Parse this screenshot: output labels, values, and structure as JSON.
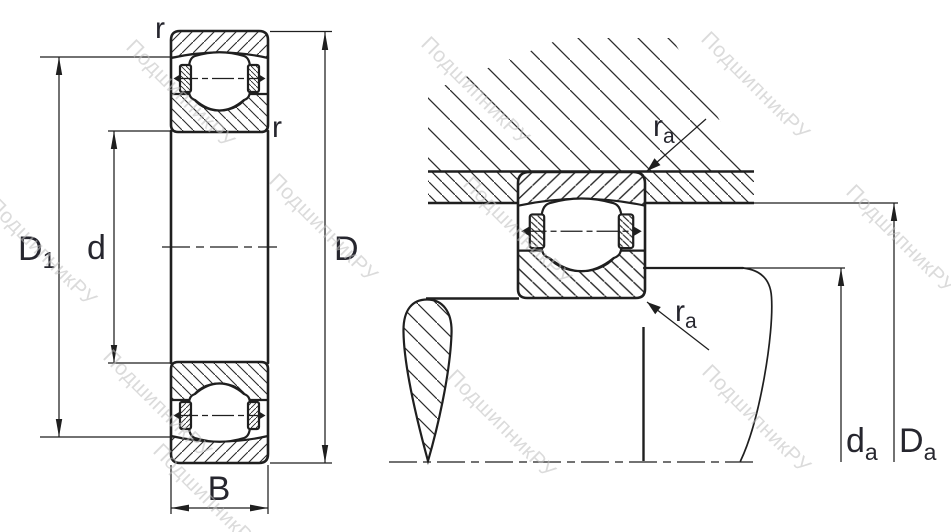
{
  "drawing": {
    "type": "bearing-dimension-diagram",
    "watermark": {
      "text": "ПодшипникРУ"
    },
    "left_view": {
      "label_r_top": "r",
      "label_r_side": "r",
      "dim_D1": {
        "base": "D",
        "sub": "1"
      },
      "dim_d": "d",
      "dim_D": "D",
      "dim_B": "B"
    },
    "right_view": {
      "label_ra_top": {
        "base": "r",
        "sub": "a"
      },
      "label_ra_bottom": {
        "base": "r",
        "sub": "a"
      },
      "dim_da": {
        "base": "d",
        "sub": "a"
      },
      "dim_Da": {
        "base": "D",
        "sub": "a"
      }
    },
    "colors": {
      "line": "#1f1f1f",
      "label": "#26262e",
      "watermark": "#bfbfbf"
    }
  }
}
